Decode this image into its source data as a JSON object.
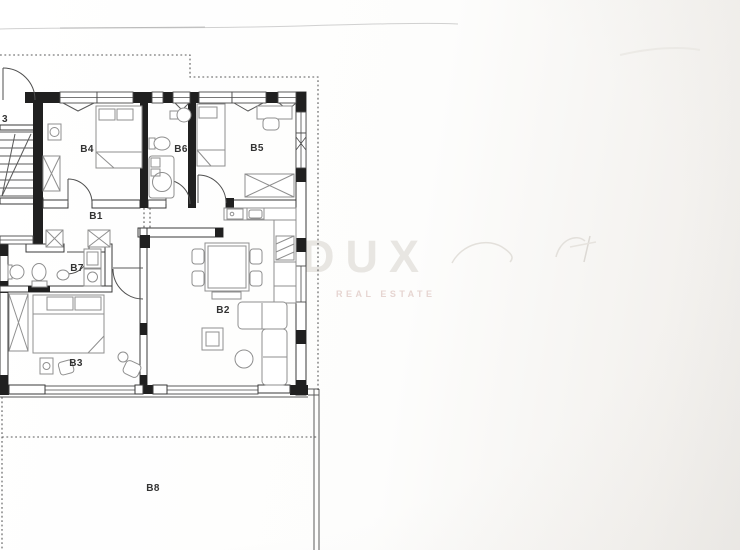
{
  "watermark": {
    "brand": "DUX",
    "tagline": "REAL ESTATE"
  },
  "rooms": {
    "b1": "B1",
    "b2": "B2",
    "b3": "B3",
    "b4": "B4",
    "b5": "B5",
    "b6": "B6",
    "b7": "B7",
    "b8": "B8",
    "stairwell": "3"
  },
  "colors": {
    "wall": "#202020",
    "wall-edge": "#3a3a3a",
    "door": "#4a4a4a",
    "boundary": "#5a5a5a",
    "furniture": "#8f8f8f",
    "label": "#333333",
    "watermark-brand": "#e8e6e2",
    "watermark-tagline": "#e6d5d1",
    "paper": "#ffffff",
    "paper-shade": "#edebe8"
  }
}
